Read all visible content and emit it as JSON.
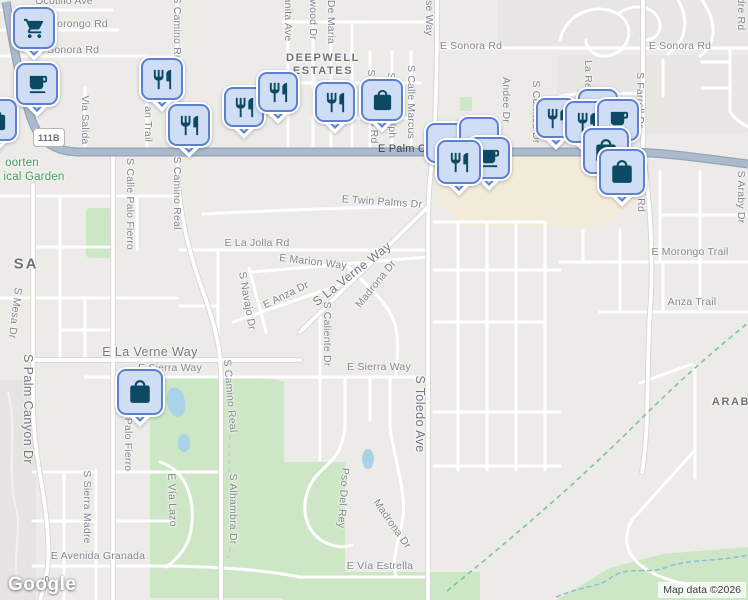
{
  "attribution": {
    "text": "Map data ©2026"
  },
  "logo": {
    "text": "Google"
  },
  "shield": {
    "text": "111B"
  },
  "colors": {
    "land": "#edebe8",
    "road": "#ffffff",
    "highway": "#acbbcb",
    "park_green": "#cde7c6",
    "water": "#a9d3e9",
    "commercial": "#f3ebd9",
    "pin_fill": "#cfddf5",
    "pin_border": "#5d80d0",
    "pin_icon": "#0c4963",
    "park_text": "#3d9b54",
    "label_text": "#81858c"
  },
  "labels": [
    {
      "t": "Ocotillo Ave",
      "x": 64,
      "y": 1
    },
    {
      "t": "Morongo Rd",
      "x": 78,
      "y": 24
    },
    {
      "t": "E Sonora Rd",
      "x": 68,
      "y": 50
    },
    {
      "t": "E Sonora Rd",
      "x": 471,
      "y": 46
    },
    {
      "t": "E Sonora Rd",
      "x": 680,
      "y": 46
    },
    {
      "t": "Via Salida",
      "x": 85,
      "y": 120,
      "r": 90
    },
    {
      "t": "an Trail",
      "x": 148,
      "y": 124,
      "r": 90
    },
    {
      "t": "S Camino Real",
      "x": 177,
      "y": 33,
      "r": 90
    },
    {
      "t": "anita Ave",
      "x": 288,
      "y": 19,
      "r": 90
    },
    {
      "t": "twood Dr",
      "x": 313,
      "y": 18,
      "r": 90
    },
    {
      "t": "De Maria",
      "x": 331,
      "y": 22,
      "r": 90
    },
    {
      "t": "se Way",
      "x": 429,
      "y": 18,
      "r": 90
    },
    {
      "t": "DEEPWELL",
      "x": 323,
      "y": 58,
      "c": "nb"
    },
    {
      "t": "ESTATES",
      "x": 323,
      "y": 71,
      "c": "nb"
    },
    {
      "t": "Sa",
      "x": 371,
      "y": 76,
      "r": 90
    },
    {
      "t": "n Rd",
      "x": 374,
      "y": 132,
      "r": 90
    },
    {
      "t": "S",
      "x": 391,
      "y": 76,
      "r": 90
    },
    {
      "t": "olph",
      "x": 392,
      "y": 128,
      "r": 90
    },
    {
      "t": "S Calle Marcus",
      "x": 411,
      "y": 102,
      "r": 90
    },
    {
      "t": "E Palm C",
      "x": 402,
      "y": 149,
      "c": "hw"
    },
    {
      "t": "oorten",
      "x": 22,
      "y": 163,
      "c": "park"
    },
    {
      "t": "ical Garden",
      "x": 34,
      "y": 177,
      "c": "park"
    },
    {
      "t": "S Calle Palo Fierro",
      "x": 130,
      "y": 204,
      "r": 90
    },
    {
      "t": "S Camino Real",
      "x": 177,
      "y": 193,
      "r": 90
    },
    {
      "t": "SA",
      "x": 26,
      "y": 264,
      "c": "nb big"
    },
    {
      "t": "S Mesa Dr",
      "x": 15,
      "y": 313,
      "r": 97
    },
    {
      "t": "E Twin Palms Dr",
      "x": 382,
      "y": 202,
      "r": 4
    },
    {
      "t": "E La Jolla Rd",
      "x": 257,
      "y": 243
    },
    {
      "t": "E Marion Way",
      "x": 313,
      "y": 262,
      "r": 7
    },
    {
      "t": "S La Verne Way",
      "x": 352,
      "y": 274,
      "r": -38,
      "c": "art"
    },
    {
      "t": "Madrona Dr",
      "x": 376,
      "y": 284,
      "r": -51
    },
    {
      "t": "E Anza Dr",
      "x": 286,
      "y": 295,
      "r": -26
    },
    {
      "t": "S Navajo Dr",
      "x": 247,
      "y": 301,
      "r": 80
    },
    {
      "t": "S Caliente Dr",
      "x": 327,
      "y": 334,
      "r": 90
    },
    {
      "t": "E Morongo Trail",
      "x": 690,
      "y": 252
    },
    {
      "t": "Anza Trail",
      "x": 692,
      "y": 302
    },
    {
      "t": "Andee Dr",
      "x": 506,
      "y": 100,
      "r": 90
    },
    {
      "t": "S Cerritos Dr",
      "x": 536,
      "y": 112,
      "r": 90
    },
    {
      "t": "La Reina Way",
      "x": 588,
      "y": 94,
      "r": 90
    },
    {
      "t": "S Farrell Dr",
      "x": 640,
      "y": 100,
      "r": 90
    },
    {
      "t": "dre Rd",
      "x": 741,
      "y": 14,
      "r": 90
    },
    {
      "t": "Barona Rd",
      "x": 641,
      "y": 186,
      "r": 90
    },
    {
      "t": "S Araby Dr",
      "x": 741,
      "y": 197,
      "r": 90
    },
    {
      "t": "E La Verne Way",
      "x": 150,
      "y": 352,
      "c": "art"
    },
    {
      "t": "E Sierra Way",
      "x": 170,
      "y": 368
    },
    {
      "t": "E Sierra Way",
      "x": 379,
      "y": 367
    },
    {
      "t": "S Toledo Ave",
      "x": 420,
      "y": 414,
      "r": 90,
      "c": "art"
    },
    {
      "t": "S Palm Canyon Dr",
      "x": 28,
      "y": 409,
      "r": 90,
      "c": "art"
    },
    {
      "t": "e Palo Fierro",
      "x": 128,
      "y": 440,
      "r": 90
    },
    {
      "t": "S Camino Real",
      "x": 230,
      "y": 396,
      "r": 85
    },
    {
      "t": "S Sierra Madre",
      "x": 87,
      "y": 507,
      "r": 90
    },
    {
      "t": "E Vía Lazo",
      "x": 172,
      "y": 500,
      "r": 88
    },
    {
      "t": "S Alhambra Dr",
      "x": 233,
      "y": 509,
      "r": 90
    },
    {
      "t": "E Avenida Granada",
      "x": 98,
      "y": 556
    },
    {
      "t": "Pso Del Rey",
      "x": 343,
      "y": 498,
      "r": 94
    },
    {
      "t": "Madrona Dr",
      "x": 392,
      "y": 524,
      "r": 55
    },
    {
      "t": "E Vía Estrella",
      "x": 380,
      "y": 566
    },
    {
      "t": "ARAB",
      "x": 731,
      "y": 402,
      "c": "nb"
    },
    {
      "t": "S",
      "x": 45,
      "y": 580,
      "r": 60
    }
  ],
  "markers": [
    {
      "icon": "bag",
      "x": -4,
      "y": 120,
      "s": 42
    },
    {
      "icon": "cart",
      "x": 34,
      "y": 28,
      "s": 42
    },
    {
      "icon": "cafe",
      "x": 37,
      "y": 84,
      "s": 42
    },
    {
      "icon": "restaurant",
      "x": 162,
      "y": 79,
      "s": 42
    },
    {
      "icon": "restaurant",
      "x": 189,
      "y": 125,
      "s": 42
    },
    {
      "icon": "restaurant",
      "x": 244,
      "y": 107,
      "s": 40
    },
    {
      "icon": "restaurant",
      "x": 278,
      "y": 92,
      "s": 40
    },
    {
      "icon": "restaurant",
      "x": 335,
      "y": 102,
      "s": 40
    },
    {
      "icon": "bag",
      "x": 382,
      "y": 100,
      "s": 42
    },
    {
      "icon": "",
      "x": 446,
      "y": 143,
      "s": 40
    },
    {
      "icon": "",
      "x": 479,
      "y": 137,
      "s": 40
    },
    {
      "icon": "cafe",
      "x": 489,
      "y": 158,
      "s": 42
    },
    {
      "icon": "restaurant",
      "x": 459,
      "y": 162,
      "s": 44
    },
    {
      "icon": "restaurant",
      "x": 556,
      "y": 118,
      "s": 40
    },
    {
      "icon": "",
      "x": 598,
      "y": 109,
      "s": 40
    },
    {
      "icon": "restaurant",
      "x": 586,
      "y": 122,
      "s": 42
    },
    {
      "icon": "cafe",
      "x": 618,
      "y": 120,
      "s": 42
    },
    {
      "icon": "bag",
      "x": 606,
      "y": 151,
      "s": 46
    },
    {
      "icon": "bag",
      "x": 622,
      "y": 172,
      "s": 46
    },
    {
      "icon": "bag",
      "x": 140,
      "y": 392,
      "s": 46
    }
  ]
}
